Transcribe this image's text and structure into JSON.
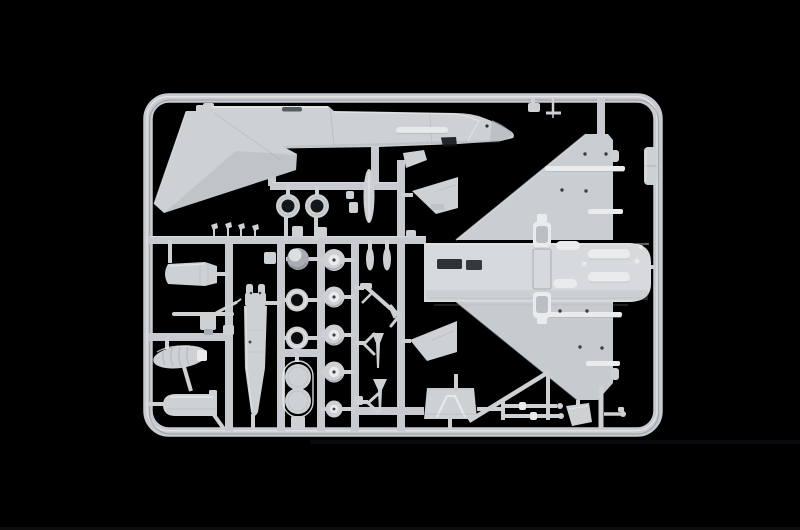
{
  "scene": {
    "alt_text": "Photograph of a light grey injection-moulded plastic model kit sprue (runner frame) on a black background. The sprue holds parts for a delta-wing jet aircraft model: a fuselage half with nose along the top, a swept vertical tail fin at the upper left, a large delta wing with belly section on the right, plus wheels, tires, engine face rings, a sphere, drop tank, exhaust nozzle, intake screen, pylon, landing-gear struts, doors and small antennas arranged on internal runners."
  },
  "colors": {
    "background": "#000000",
    "plastic": "#cdd1d4",
    "plastic_light": "#e9ebec",
    "plastic_dark": "#a7adb2",
    "plastic_deep": "#777e84",
    "bar": "#c7cbcf",
    "hole": "#0b0d0e",
    "recess": "#15181b",
    "bottom_edge": "#161616"
  },
  "parts": {
    "frame": "sprue outer frame",
    "runners": "internal runner bars",
    "fuselage": "fuselage half with nose and canopy",
    "tail_fin": "swept vertical tail fin",
    "delta_wing": "delta wing with belly section",
    "engine_nozzle": "exhaust nozzle cone",
    "control_arm": "control arm lever",
    "intake_screen": "intake debris screen",
    "drop_tank": "drop tank half",
    "pylon_seat": "pylon / seat part",
    "sphere": "spherical dome part",
    "tire_rings": "hollow tire rings",
    "engine_rings": "engine face rings",
    "canopy_discs": "twin disc frame part",
    "wheels": "main and nose wheels",
    "blades": "blade / fin antennas",
    "gear_parts": "landing gear struts, darts and braces",
    "ramp": "ramp / speed brake panel",
    "gear_door": "landing gear door",
    "gear_ladder": "gear leg rods",
    "ecm_pod": "small pod on right frame bar",
    "antenna_pins": "four tiny antenna pins",
    "pitot": "T-shaped pitot probe"
  }
}
